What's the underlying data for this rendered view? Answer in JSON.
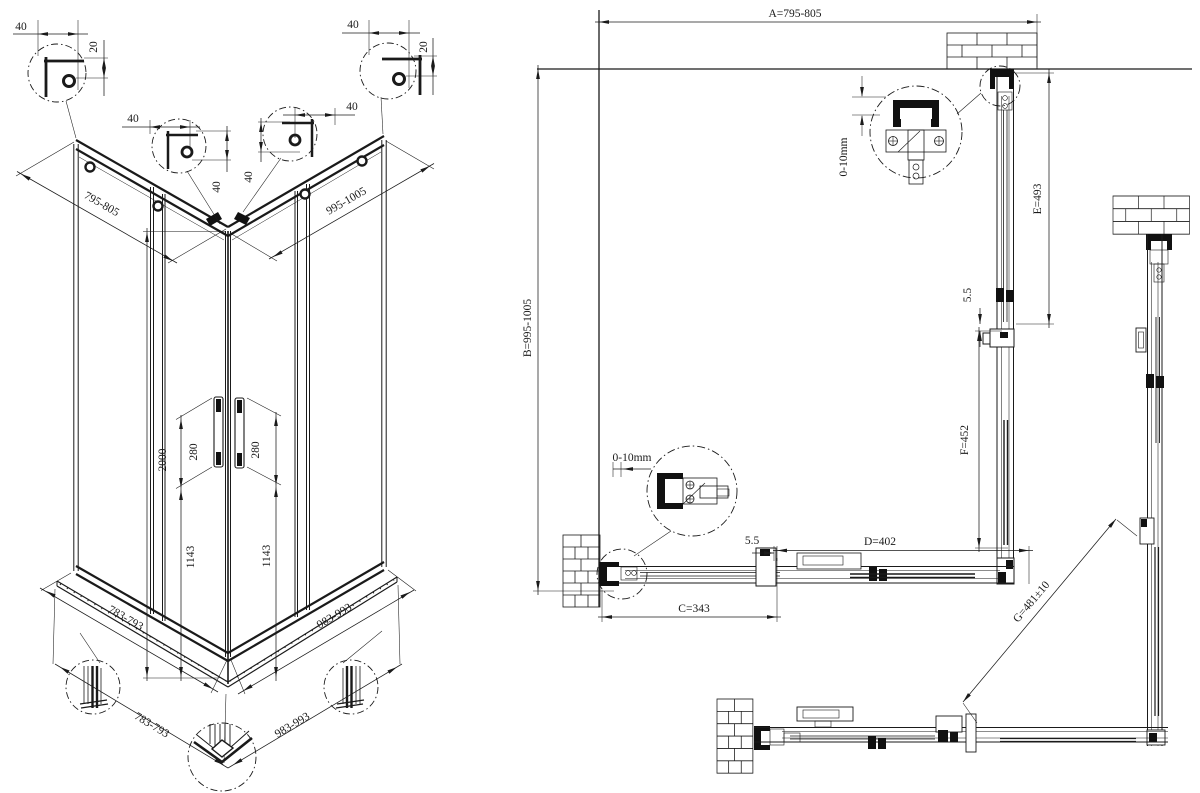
{
  "colors": {
    "line": "#1a1a1a",
    "background": "#ffffff"
  },
  "left_view": {
    "corner_detail_top_left": {
      "width": "40",
      "height": "20"
    },
    "corner_detail_mid_left": {
      "width": "40",
      "height": "40"
    },
    "corner_detail_mid_right": {
      "width": "40",
      "height": "40"
    },
    "corner_detail_top_right": {
      "width": "40",
      "height": "20"
    },
    "top_width_left": "795-805",
    "top_width_right": "995-1005",
    "height": "2000",
    "handle_length_left": "280",
    "handle_length_right": "280",
    "handle_height_left": "1143",
    "handle_height_right": "1143",
    "tray_width_left": "783-793",
    "tray_width_right": "983-993",
    "base_width_left": "783-793",
    "base_width_right": "983-993"
  },
  "plan_view": {
    "width_a": "A=795-805",
    "depth_b": "B=995-1005",
    "fixed_e": "E=493",
    "gap_right": "5.5",
    "door_f": "F=452",
    "door_d": "D=402",
    "gap_bottom": "5.5",
    "fixed_c": "C=343",
    "entry_g": "G=481±10",
    "wall_adjust_top": "0-10mm",
    "wall_adjust_left": "0-10mm"
  }
}
